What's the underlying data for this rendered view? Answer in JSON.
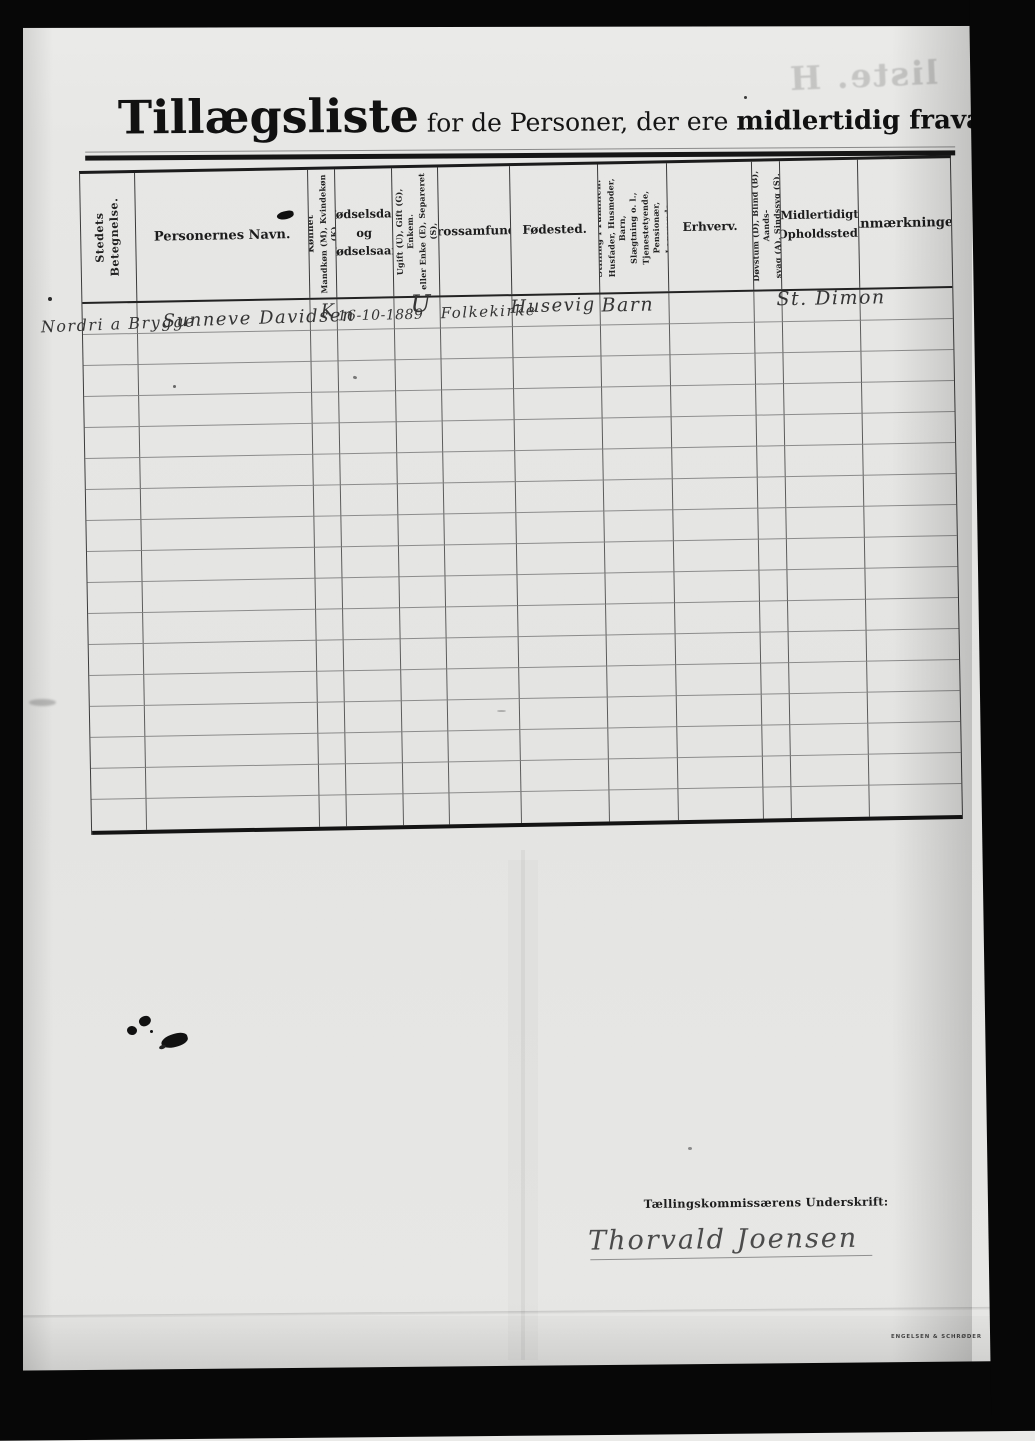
{
  "page": {
    "title": {
      "main": "Tillægsliste",
      "mid": " for de Personer, der ere ",
      "emph": "midlertidig fraværende."
    },
    "ghost_bleedthrough_text": "liste. H",
    "printer_mark": "ENGELSEN & SCHRØDER"
  },
  "table": {
    "headers": {
      "c1": {
        "lines": [
          "Stedets Betegnelse."
        ]
      },
      "c2": {
        "label": "Personernes Navn."
      },
      "c3": {
        "lines": [
          "Kønnet",
          "Mandkøn (M), Kvindekøn (K)"
        ]
      },
      "c4": {
        "label": "Fødselsdag\nog\nFødselsaar."
      },
      "c5": {
        "lines": [
          "Ægteskabelig Stilling.",
          "Ugift (U), Gift (G), Enkem.",
          "eller Enke (E), Separeret (S),",
          "Fraskilt (F)"
        ]
      },
      "c6": {
        "label": "Trossamfund."
      },
      "c7": {
        "label": "Fødested."
      },
      "c8": {
        "lines": [
          "Stilling i Familien:",
          "Husfader, Husmoder, Barn,",
          "Slægtning o. l.,",
          "Tjenestetyende, Pensionær,",
          "Logerende."
        ]
      },
      "c9": {
        "label": "Erhverv."
      },
      "c10": {
        "lines": [
          "Døvstum (D), Blind (B), Aands-",
          "svag (A), Sindssyg (S)."
        ]
      },
      "c11": {
        "label": "Midlertidigt\nOpholdssted."
      },
      "c12": {
        "label": "Anmærkninger"
      }
    },
    "row_count": 17,
    "entries": [
      {
        "place": "Nordri a Brygge",
        "name": "Sunneve Davidsen",
        "sex": "K",
        "birthdate": "16-10-1889",
        "marital_status": "U",
        "faith": "Folkekirke",
        "birthplace": "Husevig",
        "family_position": "Barn",
        "occupation": "",
        "temporary_residence": "St. Dimon",
        "remarks": ""
      }
    ]
  },
  "signature": {
    "label": "Tællingskommissærens Underskrift:",
    "name": "Thorvald Joensen"
  }
}
